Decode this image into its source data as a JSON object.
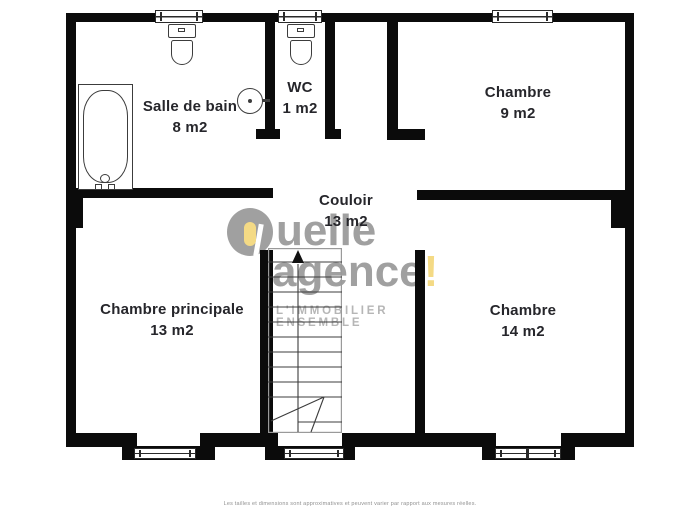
{
  "plan": {
    "rooms": {
      "salle_de_bain": {
        "name": "Salle de bain",
        "area": "8 m2"
      },
      "wc": {
        "name": "WC",
        "area": "1 m2"
      },
      "chambre_haut": {
        "name": "Chambre",
        "area": "9 m2"
      },
      "couloir": {
        "name": "Couloir",
        "area": "13 m2"
      },
      "chambre_principale": {
        "name": "Chambre principale",
        "area": "13 m2"
      },
      "chambre_bas": {
        "name": "Chambre",
        "area": "14 m2"
      }
    },
    "icons": {
      "bathtub": "bathtub-icon",
      "toilet_salle_de_bain": "toilet-icon",
      "toilet_wc": "toilet-icon",
      "washbasin": "sink-icon",
      "staircase": "staircase-icon",
      "stairs_direction": "arrow-up-icon"
    }
  },
  "logo": {
    "text_top": "uelle",
    "text_bottom": "agence",
    "exclamation": "!",
    "tagline": "L'IMMOBILIER ENSEMBLE"
  },
  "footer": {
    "disclaimer": "Les tailles et dimensions sont approximatives et peuvent varier par rapport aux mesures réelles."
  },
  "colors": {
    "wall": "#0b0b0b",
    "logo_gray": "#a0a0a0",
    "logo_yellow": "#f4da85",
    "tagline_gray": "#b6b6b6",
    "label_text": "#26262b"
  }
}
